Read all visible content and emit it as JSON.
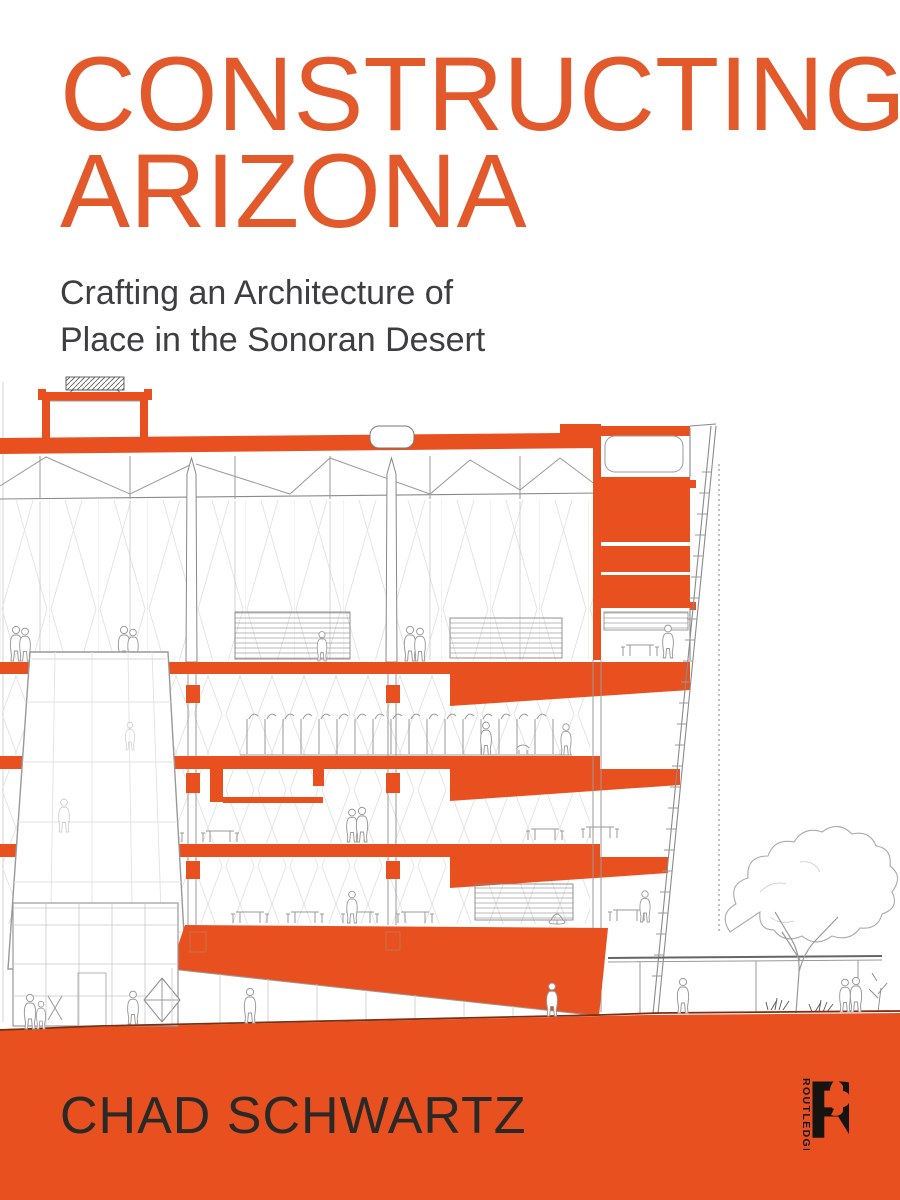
{
  "cover": {
    "title": {
      "line1": "CONSTRUCTING",
      "line2": "ARIZONA"
    },
    "subtitle": {
      "line1": "Crafting an Architecture of",
      "line2": "Place in the Sonoran Desert"
    },
    "author": "CHAD SCHWARTZ",
    "publisher": {
      "name": "ROUTLEDGE",
      "mark": "R"
    },
    "artwork": {
      "description": "Architectural cross-section drawing of a building with orange floor slabs, figures, trees and a sloped screen facade"
    },
    "colors": {
      "accent": "#E8511F",
      "title": "#E25A2B",
      "subtitle_ink": "#3E3E40",
      "author_ink": "#2A2927",
      "logo_ink": "#161310"
    }
  }
}
